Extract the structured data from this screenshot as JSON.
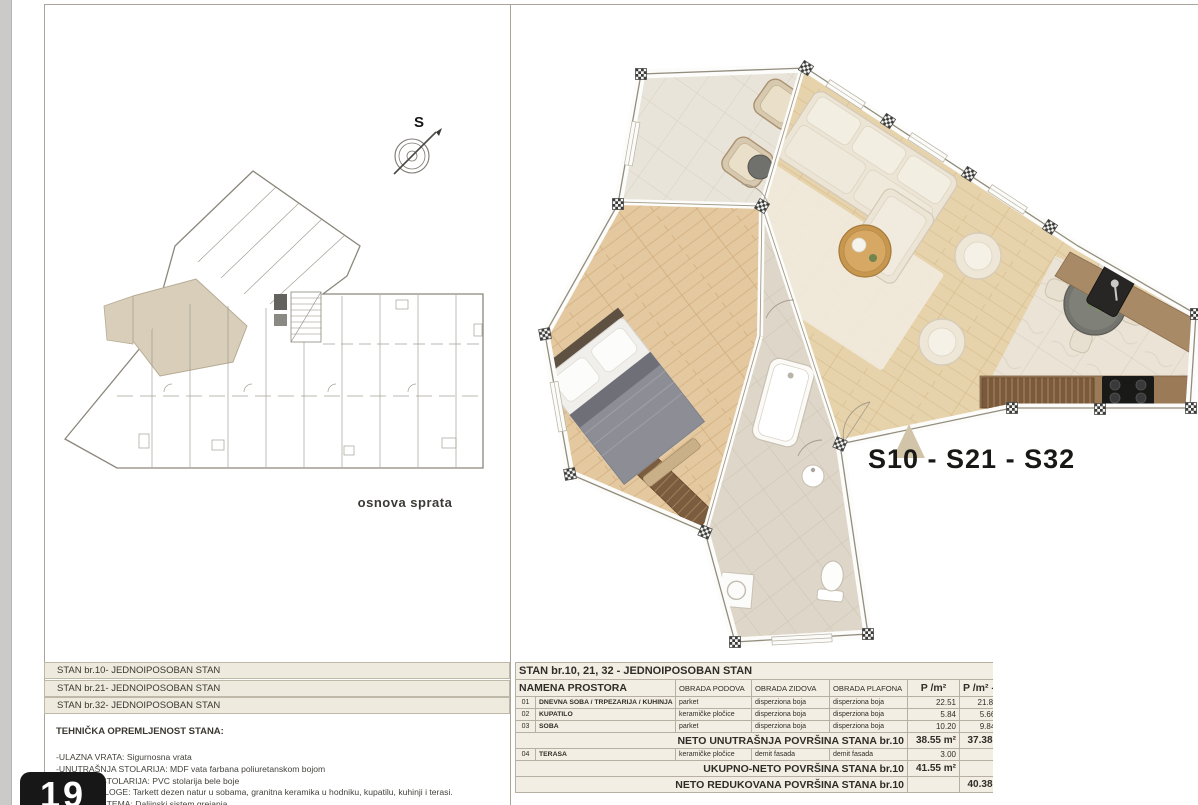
{
  "page": {
    "badge": "19"
  },
  "left_panel": {
    "plan_caption": "osnova sprata",
    "compass_label": "S"
  },
  "right_panel": {
    "apartment_label": "S10 - S21 - S32",
    "triangle_color": "#d2c4a8",
    "highlight_color": "#d8ceba"
  },
  "apartment_list": [
    "STAN br.10- JEDNOIPOSOBAN STAN",
    "STAN br.21- JEDNOIPOSOBAN STAN",
    "STAN br.32- JEDNOIPOSOBAN STAN"
  ],
  "tech": {
    "heading": "TEHNIČKA OPREMLJENOST STANA:",
    "lines": [
      "-ULAZNA VRATA: Sigurnosna vrata",
      "-UNUTRAŠNJA STOLARIJA: MDF vata farbana poliuretanskom bojom",
      "-FASADNA STOLARIJA: PVC stolarija bele boje",
      "-PODNE OBLOGE: Tarkett dezen natur u sobama, granitna keramika u hodniku, kupatilu, kuhinji i terasi.",
      "-GREJNI SISTEMA: Daljinski sistem grejanja"
    ]
  },
  "area_table": {
    "rows": [
      {
        "type": "title",
        "label": "STAN br.10, 21, 32 - JEDNOIPOSOBAN STAN"
      },
      {
        "type": "header",
        "cells": [
          "NAMENA PROSTORA",
          "OBRADA PODOVA",
          "OBRADA ZIDOVA",
          "OBRADA PLAFONA",
          "P /m²",
          "P /m² - 30%"
        ]
      },
      {
        "type": "room",
        "cells": [
          "01",
          "DNEVNA SOBA / TRPEZARIJA / KUHINJA",
          "parket",
          "disperziona boja",
          "disperziona boja",
          "22.51",
          "21.88"
        ]
      },
      {
        "type": "room",
        "cells": [
          "02",
          "KUPATILO",
          "keramičke pločice",
          "disperziona boja",
          "disperziona boja",
          "5.84",
          "5.66"
        ]
      },
      {
        "type": "room",
        "cells": [
          "03",
          "SOBA",
          "parket",
          "disperziona boja",
          "disperziona boja",
          "10.20",
          "9.84"
        ]
      },
      {
        "type": "total",
        "label": "NETO UNUTRAŠNJA POVRŠINA STANA br.10",
        "p": "38.55 m²",
        "p2": "37.38 m²"
      },
      {
        "type": "room",
        "cells": [
          "04",
          "TERASA",
          "keramičke pločice",
          "demit fasada",
          "demit fasada",
          "3.00",
          ""
        ]
      },
      {
        "type": "total",
        "label": "UKUPNO-NETO POVRŠINA STANA br.10",
        "p": "41.55 m²",
        "p2": ""
      },
      {
        "type": "total",
        "label": "NETO REDUKOVANA POVRŠINA STANA br.10",
        "p": "",
        "p2": "40.38 m²"
      }
    ]
  }
}
